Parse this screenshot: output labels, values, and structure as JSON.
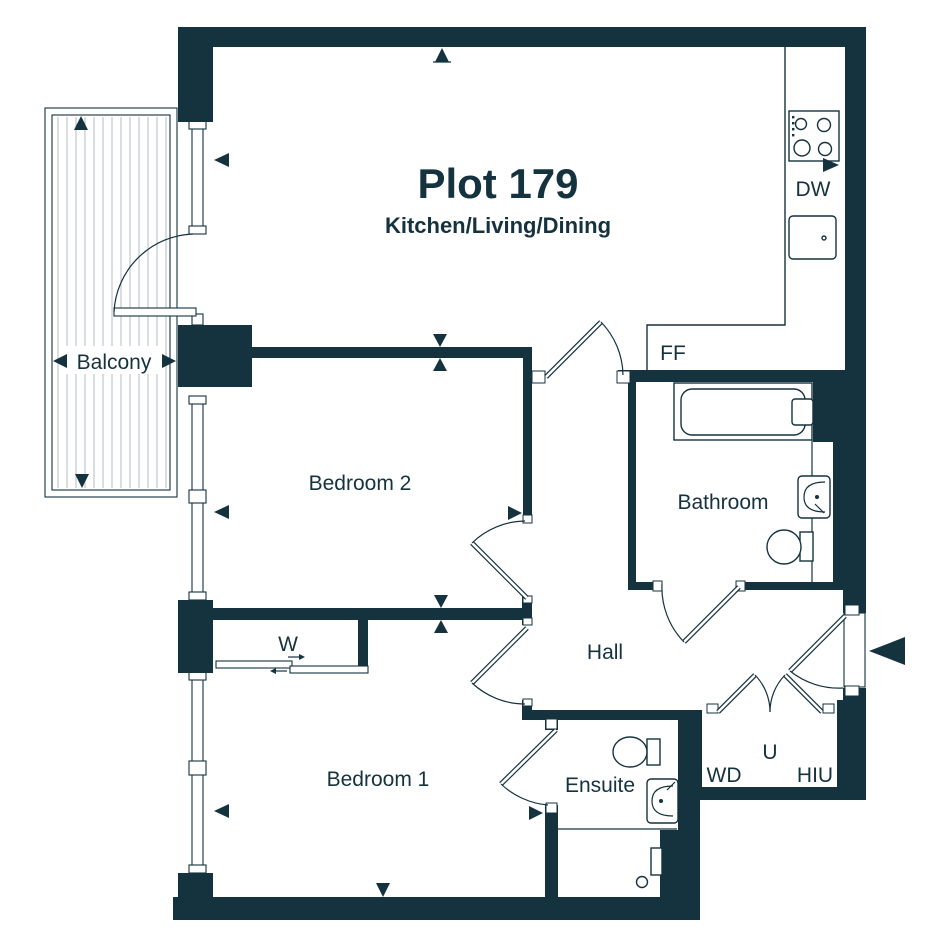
{
  "plan": {
    "title": "Plot 179",
    "subtitle": "Kitchen/Living/Dining"
  },
  "labels": {
    "balcony": "Balcony",
    "bedroom2": "Bedroom 2",
    "bathroom": "Bathroom",
    "hall": "Hall",
    "bedroom1": "Bedroom 1",
    "ensuite": "Ensuite",
    "wardrobe": "W",
    "utility": "U",
    "washer_dryer": "WD",
    "heat_interface_unit": "HIU",
    "dishwasher": "DW",
    "fridge_freezer": "FF"
  },
  "colors": {
    "wall": "#15323f",
    "line": "#15323f",
    "background": "#ffffff"
  }
}
